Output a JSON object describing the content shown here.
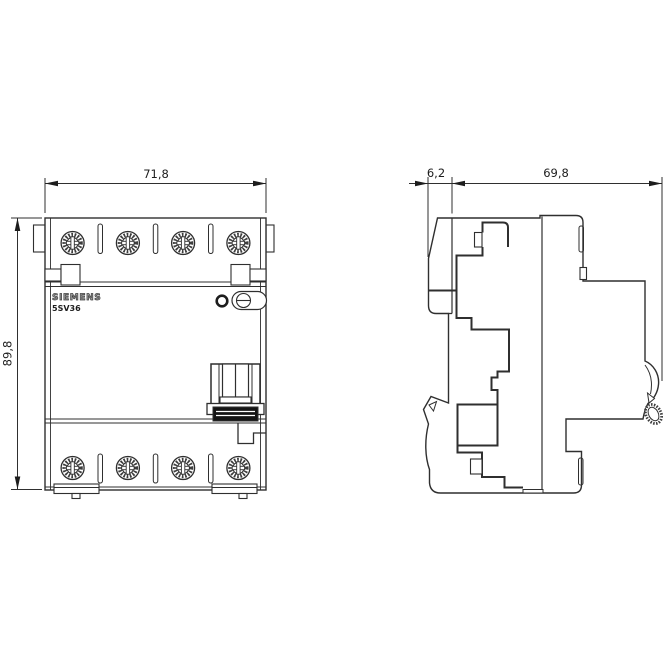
{
  "front_view": {
    "width_mm": "71,8",
    "height_mm": "89,8",
    "brand": "SIEMENS",
    "model": "5SV36"
  },
  "side_view": {
    "handle_depth_mm": "6,2",
    "body_depth_mm": "69,8"
  },
  "style": {
    "line_color": "#2f2f2f",
    "background": "#ffffff",
    "dark_fill": "#141414"
  },
  "icons": {
    "terminal_screw": "knurled-cross-screw-circle",
    "test_button": "bold-ring-circle",
    "seal_screw": "slotted-screw-in-stadium",
    "din_roller": "knurled-oval-roller",
    "dimension_arrow": "filled-triangle-arrowhead"
  }
}
